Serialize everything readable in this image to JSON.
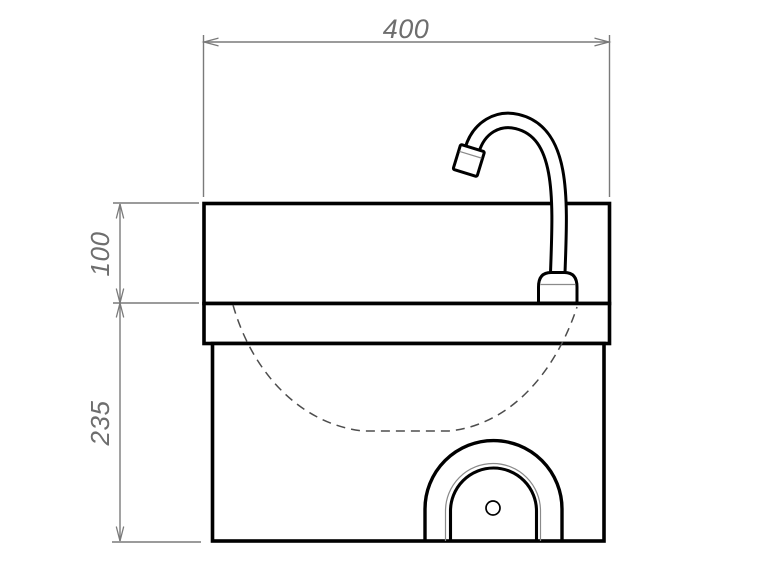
{
  "drawing": {
    "dimensions": {
      "top_width": "400",
      "upper_height": "100",
      "lower_height": "235"
    },
    "colors": {
      "object_line": "#000000",
      "dimension_line": "#7a7a7a",
      "dimension_text": "#6e6e6e",
      "hidden_line": "#4d4d4d",
      "background": "#ffffff"
    }
  }
}
